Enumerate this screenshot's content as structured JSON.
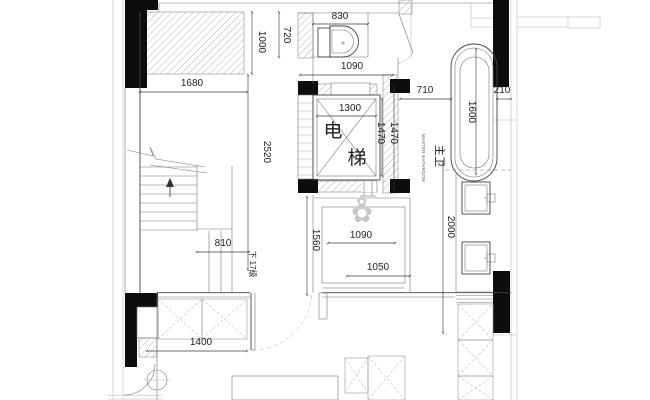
{
  "labels": {
    "elevator_char1": "电",
    "elevator_char2": "梯",
    "master_bath_cn": "主卫",
    "master_bath_en": "MASTER BATHROOM",
    "stair_note": "下 17级",
    "flower_glyph": "✿"
  },
  "dims": {
    "toilet_alcove_width": "830",
    "bath_room_width": "1090",
    "closet_width": "1680",
    "closet_depth": "1000",
    "toilet_depth": "720",
    "stair_side_depth": "2520",
    "elevator_width": "1300",
    "elevator_depth_inner": "1470",
    "elevator_depth_outer": "1470",
    "tub_clearance": "710",
    "tub_length": "1600",
    "tub_side_gap": "210",
    "stair_flight_width": "810",
    "shower_room_depth": "1560",
    "shower_room_width": "1090",
    "vanity_run_depth": "2000",
    "shower_inner_width": "1050",
    "wardrobe_width": "1400"
  },
  "colors": {
    "wall": "#0d0d0d",
    "line": "#444444",
    "hatch": "#adadad",
    "dim_text": "#1f1f1f",
    "background": "#ffffff"
  }
}
